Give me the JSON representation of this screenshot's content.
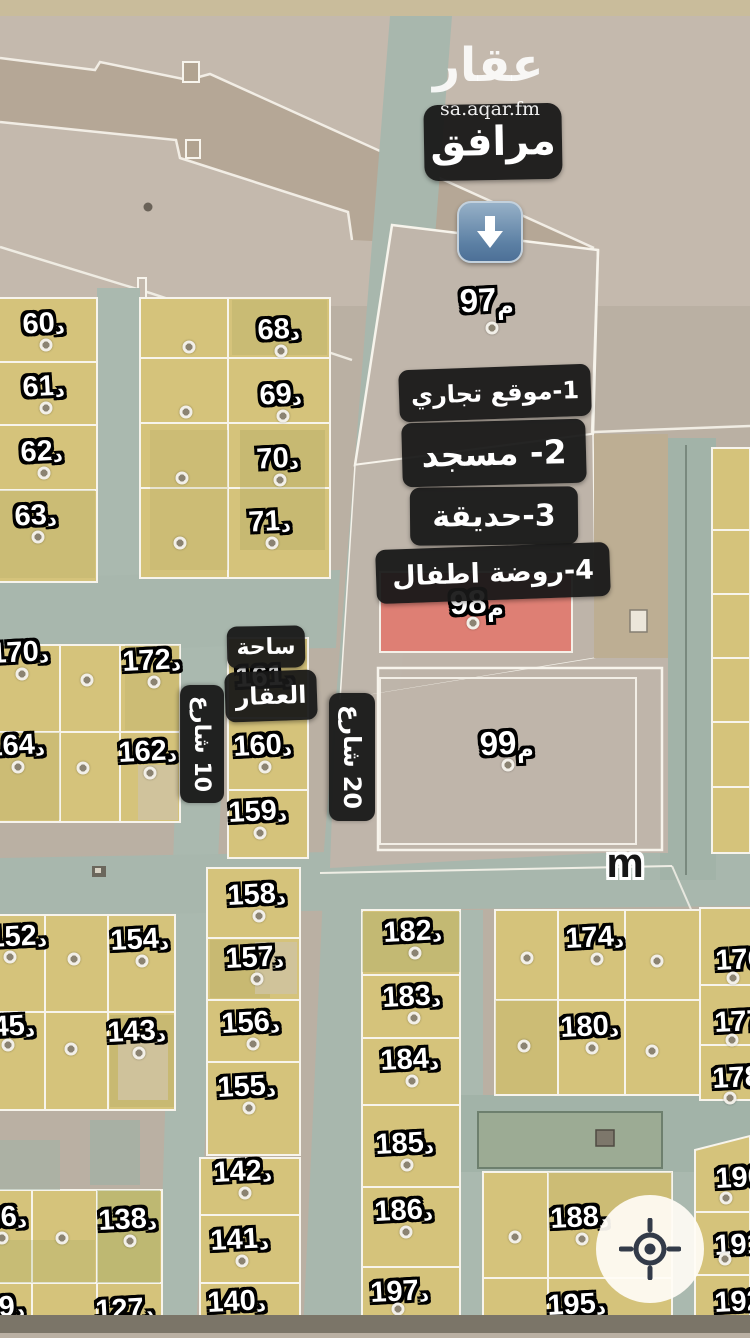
{
  "branding": {
    "logo": "عقار",
    "site": "sa.aqar.fm"
  },
  "labels": {
    "facilities": "مرافق",
    "legend": [
      "1-موقع تجاري",
      "2- مسجد",
      "3-حديقة",
      "4-روضة اطفال"
    ],
    "plaza1": "ساحة",
    "plaza2": "العقار",
    "m": "m"
  },
  "streets": {
    "s10": {
      "name": "شارع",
      "num": "10"
    },
    "s20": {
      "name": "شارع",
      "num": "20"
    }
  },
  "parcel_suffix": "د",
  "meter_suffix": "م",
  "parcels": [
    {
      "n": "60",
      "x": 44,
      "y": 324
    },
    {
      "n": "61",
      "x": 44,
      "y": 387
    },
    {
      "n": "62",
      "x": 42,
      "y": 452
    },
    {
      "n": "63",
      "x": 36,
      "y": 516
    },
    {
      "n": "68",
      "x": 279,
      "y": 330
    },
    {
      "n": "69",
      "x": 281,
      "y": 395
    },
    {
      "n": "70",
      "x": 278,
      "y": 459
    },
    {
      "n": "71",
      "x": 270,
      "y": 522
    },
    {
      "n": "170",
      "x": 20,
      "y": 653
    },
    {
      "n": "172",
      "x": 152,
      "y": 661
    },
    {
      "n": "164",
      "x": 16,
      "y": 746
    },
    {
      "n": "162",
      "x": 148,
      "y": 752
    },
    {
      "n": "161",
      "x": 265,
      "y": 677
    },
    {
      "n": "160",
      "x": 263,
      "y": 746
    },
    {
      "n": "159",
      "x": 258,
      "y": 812
    },
    {
      "n": "158",
      "x": 257,
      "y": 895
    },
    {
      "n": "157",
      "x": 255,
      "y": 958
    },
    {
      "n": "156",
      "x": 251,
      "y": 1023
    },
    {
      "n": "155",
      "x": 247,
      "y": 1087
    },
    {
      "n": "152",
      "x": 18,
      "y": 937,
      "d": [
        -8,
        20
      ]
    },
    {
      "n": "154",
      "x": 140,
      "y": 940
    },
    {
      "n": "145",
      "x": 6,
      "y": 1027,
      "d": [
        2,
        18
      ]
    },
    {
      "n": "143",
      "x": 137,
      "y": 1032
    },
    {
      "n": "136",
      "x": -2,
      "y": 1218,
      "d": [
        4,
        20
      ]
    },
    {
      "n": "138",
      "x": 128,
      "y": 1220
    },
    {
      "n": "129",
      "x": -4,
      "y": 1308,
      "d": 0
    },
    {
      "n": "127",
      "x": 125,
      "y": 1310,
      "d": 0
    },
    {
      "n": "142",
      "x": 243,
      "y": 1172
    },
    {
      "n": "141",
      "x": 240,
      "y": 1240
    },
    {
      "n": "140",
      "x": 237,
      "y": 1302,
      "d": 0
    },
    {
      "n": "182",
      "x": 413,
      "y": 932
    },
    {
      "n": "183",
      "x": 412,
      "y": 997
    },
    {
      "n": "184",
      "x": 410,
      "y": 1060
    },
    {
      "n": "185",
      "x": 405,
      "y": 1144
    },
    {
      "n": "186",
      "x": 404,
      "y": 1211
    },
    {
      "n": "197",
      "x": 400,
      "y": 1292,
      "d": [
        -2,
        17
      ]
    },
    {
      "n": "174",
      "x": 595,
      "y": 938
    },
    {
      "n": "180",
      "x": 590,
      "y": 1027
    },
    {
      "n": "176",
      "x": 745,
      "y": 960,
      "d": [
        -12,
        18
      ]
    },
    {
      "n": "177",
      "x": 744,
      "y": 1022,
      "d": [
        -12,
        18
      ]
    },
    {
      "n": "178",
      "x": 742,
      "y": 1078,
      "d": [
        -12,
        20
      ]
    },
    {
      "n": "188",
      "x": 580,
      "y": 1218
    },
    {
      "n": "195",
      "x": 577,
      "y": 1305,
      "d": 0
    },
    {
      "n": "190",
      "x": 745,
      "y": 1178,
      "d": [
        -19,
        20
      ]
    },
    {
      "n": "191",
      "x": 744,
      "y": 1245,
      "d": [
        -19,
        14
      ]
    },
    {
      "n": "192",
      "x": 744,
      "y": 1302,
      "d": 0
    },
    {
      "n": "97",
      "x": 487,
      "y": 300,
      "s": "م",
      "big": 1,
      "d": [
        5,
        28
      ]
    },
    {
      "n": "98",
      "x": 477,
      "y": 602,
      "s": "م",
      "big": 1,
      "d": [
        -4,
        21
      ]
    },
    {
      "n": "99",
      "x": 507,
      "y": 743,
      "s": "م",
      "big": 1,
      "d": [
        1,
        22
      ]
    }
  ],
  "extra_dots": [
    [
      189,
      347
    ],
    [
      186,
      412
    ],
    [
      182,
      478
    ],
    [
      180,
      543
    ],
    [
      87,
      680
    ],
    [
      83,
      768
    ],
    [
      74,
      959
    ],
    [
      71,
      1049
    ],
    [
      62,
      1238
    ],
    [
      527,
      958
    ],
    [
      524,
      1046
    ],
    [
      657,
      961
    ],
    [
      652,
      1051
    ],
    [
      515,
      1237
    ]
  ],
  "colors": {
    "parcel_yellow": "#d5c37b",
    "road_teal": "#a8b7ad",
    "facility_gray": "#c0b6ab",
    "highlight_red": "#e07d72",
    "label_box": "#171717",
    "arrow_blue": "#5c80a4"
  }
}
